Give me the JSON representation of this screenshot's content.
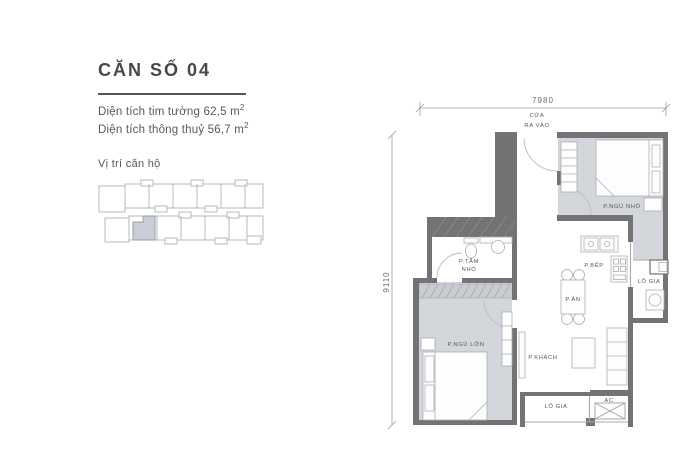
{
  "unit_info": {
    "title": "CĂN SỐ 04",
    "area_gross_label": "Diện tích tim tường 62,5 m",
    "area_gross_sup": "2",
    "area_net_label": "Diện tích thông thuỷ 56,7 m",
    "area_net_sup": "2",
    "location_label": "Vị trí căn hộ"
  },
  "floor_plan": {
    "dim_top": "7980",
    "dim_left": "9110",
    "entrance_line1": "CỬA",
    "entrance_line2": "RA VÀO",
    "rooms": {
      "bedroom_small": "P.NGỦ NHỎ",
      "bathroom_line1": "P.TẮM",
      "bathroom_line2": "NHỎ",
      "kitchen": "P.BẾP",
      "loggia_right": "LÔ GIA",
      "dining": "P.ĂN",
      "bedroom_master": "P.NGỦ LỚN",
      "living": "P.KHÁCH",
      "loggia_bottom": "LÔ GIA",
      "ac": "AC"
    }
  },
  "colors": {
    "wall": "#737376",
    "room_fill": "#d3d6da",
    "wardrobe_fill": "#c9cdd1",
    "highlight_unit": "#c9cdd7",
    "outline": "#b6babd",
    "text": "#55565a"
  }
}
